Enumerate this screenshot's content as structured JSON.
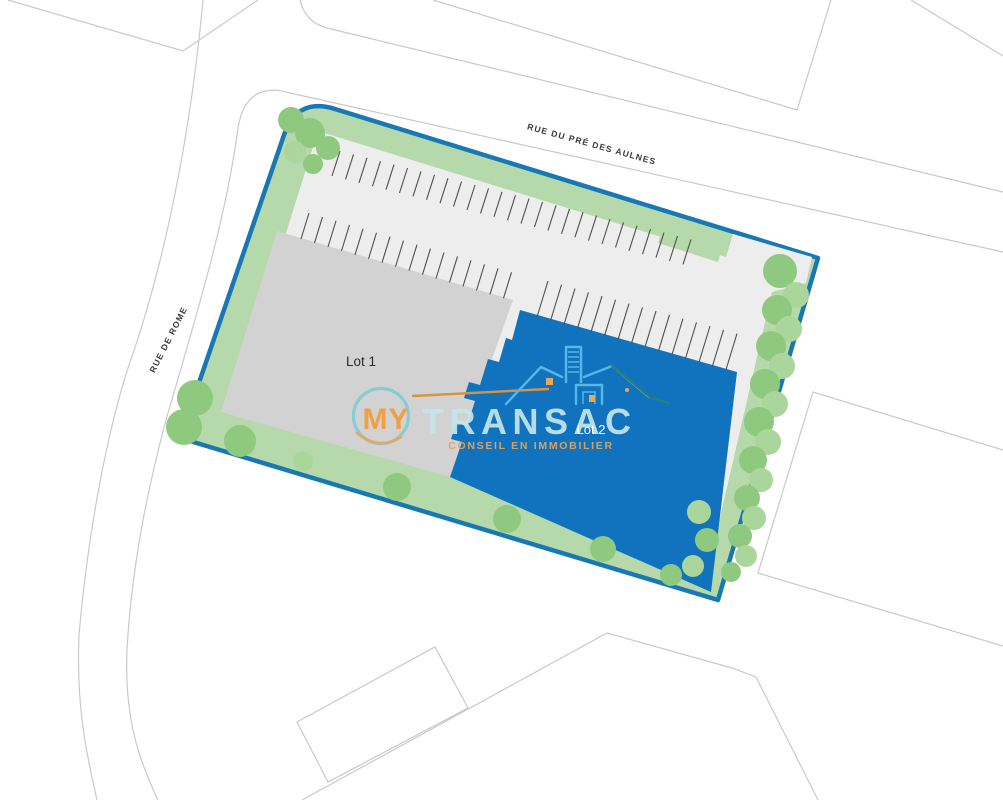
{
  "labels": {
    "street_top": "RUE DU PRÉ DES AULNES",
    "street_left": "RUE DE ROME",
    "lot1": "Lot 1",
    "lot2": "Lot 2"
  },
  "watermark": {
    "word1": "MY",
    "word2": "TRANSAC",
    "tagline": "CONSEIL EN IMMOBILIER"
  },
  "colors": {
    "boundary_blue": "#1878b4",
    "lot2_blue": "#1173bd",
    "lot1_gray": "#d2d2d2",
    "paved_gray": "#ededed",
    "green_strip": "#b5d9ab",
    "tree": "#8fc97f",
    "tree_light": "#abd69b",
    "street_line": "#c9c9cc",
    "tick": "#4f4f4f",
    "label_text": "#3a3a3a",
    "logo_orange": "#efa041",
    "logo_teal_ring": "#87ccd3",
    "logo_text_cyan": "#c6e5ea",
    "logo_tagline_orange": "#e2a45c",
    "logo_house_blue": "#55b8e6",
    "logo_house_dark": "#2f7d74"
  },
  "parking_rows": [
    {
      "x": 332,
      "y": 176,
      "dx": 13.5,
      "dy": 3.4,
      "tx": 8,
      "ty": -25,
      "n": 27
    },
    {
      "x": 301,
      "y": 239,
      "dx": 13.5,
      "dy": 3.95,
      "tx": 8,
      "ty": -26,
      "n": 16
    },
    {
      "x": 537,
      "y": 317,
      "dx": 13.5,
      "dy": 3.76,
      "tx": 11,
      "ty": -36,
      "n": 15
    }
  ],
  "trees": [
    [
      291,
      120,
      13,
      0
    ],
    [
      310,
      133,
      15,
      0
    ],
    [
      328,
      148,
      12,
      0
    ],
    [
      295,
      152,
      11,
      1
    ],
    [
      313,
      164,
      10,
      0
    ],
    [
      195,
      398,
      18,
      0
    ],
    [
      184,
      427,
      18,
      0
    ],
    [
      240,
      441,
      16,
      0
    ],
    [
      303,
      461,
      10,
      1
    ],
    [
      397,
      487,
      14,
      0
    ],
    [
      507,
      519,
      14,
      0
    ],
    [
      603,
      549,
      13,
      0
    ],
    [
      671,
      575,
      11,
      0
    ],
    [
      699,
      512,
      12,
      1
    ],
    [
      707,
      540,
      12,
      0
    ],
    [
      693,
      566,
      11,
      1
    ],
    [
      780,
      271,
      17,
      0
    ],
    [
      796,
      295,
      13,
      1
    ],
    [
      777,
      310,
      15,
      0
    ],
    [
      789,
      329,
      13,
      1
    ],
    [
      771,
      346,
      15,
      0
    ],
    [
      782,
      366,
      13,
      1
    ],
    [
      765,
      384,
      15,
      0
    ],
    [
      775,
      404,
      13,
      1
    ],
    [
      759,
      422,
      15,
      0
    ],
    [
      768,
      442,
      13,
      1
    ],
    [
      753,
      460,
      14,
      0
    ],
    [
      761,
      480,
      12,
      1
    ],
    [
      747,
      498,
      13,
      0
    ],
    [
      754,
      518,
      12,
      1
    ],
    [
      740,
      536,
      12,
      0
    ],
    [
      746,
      556,
      11,
      1
    ],
    [
      731,
      572,
      10,
      0
    ]
  ]
}
